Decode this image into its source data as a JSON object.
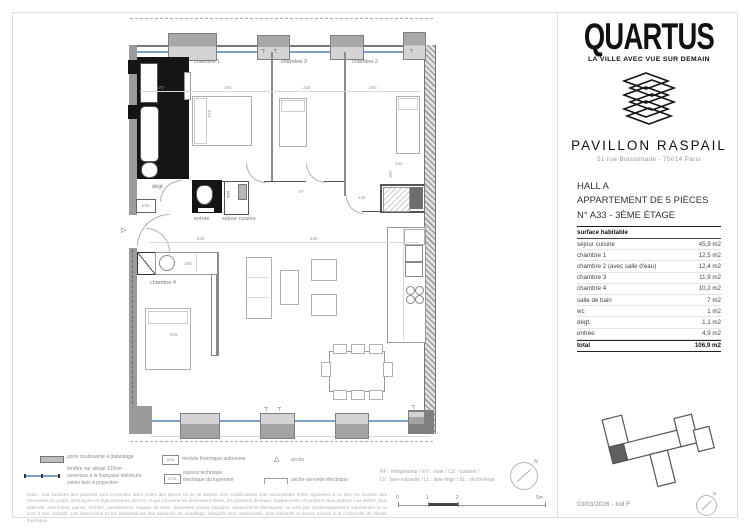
{
  "brand": {
    "name": "QUARTUS",
    "tagline": "LA VILLE AVEC VUE SUR DEMAIN",
    "project": "PAVILLON RASPAIL",
    "address": "51 rue Boissonade - 75014 Paris"
  },
  "unit": {
    "hall": "HALL A",
    "type": "APPARTEMENT DE 5 PIÈCES",
    "number": "N° A33 - 3ÈME ÉTAGE"
  },
  "surface_table": {
    "header": "surface habitable",
    "rows": [
      {
        "label": "séjour cuisine",
        "value": "45,9 m2"
      },
      {
        "label": "chambre 1",
        "value": "12,5 m2"
      },
      {
        "label": "chambre 2 (avec salle d'eau)",
        "value": "12,4 m2"
      },
      {
        "label": "chambre 3",
        "value": "11,9 m2"
      },
      {
        "label": "chambre 4",
        "value": "10,2 m2"
      },
      {
        "label": "salle de bain",
        "value": "7 m2"
      },
      {
        "label": "wc",
        "value": "1 m2"
      },
      {
        "label": "dégt.",
        "value": "1,1 m2"
      },
      {
        "label": "entrée",
        "value": "4,9 m2"
      }
    ],
    "total": {
      "label": "total",
      "value": "106,9 m2"
    }
  },
  "plan": {
    "rooms": {
      "chambre1": "chambre 1",
      "chambre2": "chambre 2",
      "chambre3": "chambre 3",
      "chambre4": "chambre 4",
      "entree": "entrée",
      "sejour": "séjour cuisine",
      "degt": "dégt.",
      "etel": "ETEL",
      "mta": "MTA"
    },
    "dims": {
      "d170": "170",
      "d290": "290",
      "d234": "234",
      "d200": "200",
      "d415": "415",
      "d240": "240",
      "d940": "940",
      "d198": "198",
      "d225": "225",
      "d126": "126",
      "d144": "144",
      "d160": "160",
      "d97": "97"
    }
  },
  "legend": {
    "porte": "porte coulissante à galandage",
    "fenetre_l1": "fenêtre sur allège 120cm",
    "fenetre_l2": "ouverture à la française intérieure",
    "fenetre_l3": "volets bois à projection",
    "mta_abbr": "MTA",
    "mta": "module thermique autonome",
    "etel_abbr": "ETEL",
    "etel_l1": "espace technique",
    "etel_l2": "électrique du logement",
    "acces": "accès",
    "seche": "sèche-serviette électrique",
    "appliances_l1": "RF : réfrigérateur / EV : évier / CU : cuisson /",
    "appliances_l2": "LV : lave-vaisselle / LL : lave-linge / SL : sèche-linge"
  },
  "scale_bar": {
    "t0": "0",
    "t1": "1",
    "t2": "2",
    "t5": "5m"
  },
  "note": "Nota : Les surfaces des placards sont comprises dans celles des pièces où ils se situent. Des modifications sont susceptibles d'être apportées à ce plan en fonction des nécessités du projet, techniques et réglementaires, tant en ce qui concerne les dimensions libres, les positions de baies, équipements et hauteurs sous plafond. Les arêtes, faux plafonds, retombées, gaines, trémies, canalisations, trappes de visite, descentes d'eaux pluviales, équipements électriques, ne sont pas systématiquement représentés ou le sont à titre indicatif. Les dimensions et les implantations des appareils de chauffage, lorsqu'ils sont représentés, sont indicatifs et seront soumis à la conformité de l'étude thermique.",
  "footer": {
    "date": "03/03/2026 - Ind F"
  },
  "icons": {
    "access_triangle": "▷",
    "legend_triangle": "△",
    "radiator": "⊤",
    "north": "N"
  },
  "colors": {
    "glazing_blue": "#7f9ec9",
    "poche_black": "#151515",
    "wall_gray": "#9a9a9a",
    "unit_highlight": "#5f5f5f"
  }
}
